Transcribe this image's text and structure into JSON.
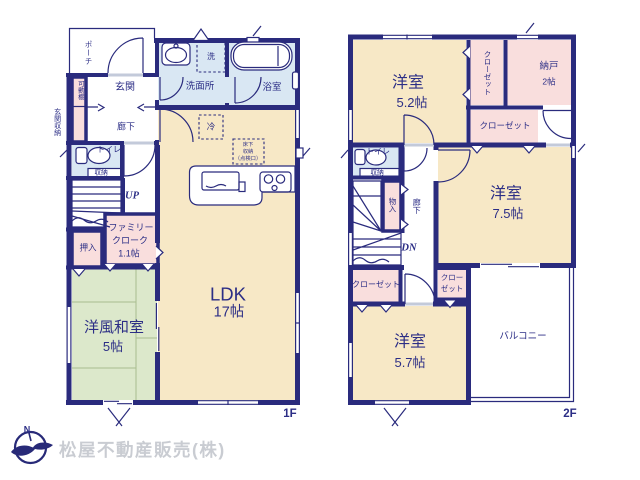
{
  "palette": {
    "wall": "#2a2b7d",
    "ink": "#2c2e86",
    "room": "#f7e8c6",
    "closet": "#f9dedd",
    "wet": "#d9e7f3",
    "tatami": "#dce8cb",
    "tatami_line": "#a9bd8f",
    "logo_text": "#c9ccd2",
    "logo_mark": "#282a78",
    "bg": "#ffffff"
  },
  "floor1": {
    "floor_label": "1F",
    "porch": "ポーチ",
    "movable_shelf": "可動棚",
    "entrance": "玄関",
    "entrance_storage": "玄関収納",
    "hallway": "廊下",
    "toilet": "トイレ",
    "toilet_storage": "収納",
    "stairs_up": "UP",
    "oshiire": "押入",
    "family_cloak_l1": "ファミリー",
    "family_cloak_l2": "クローク",
    "family_cloak_size": "1.1帖",
    "washroom": "洗面所",
    "washer": "洗",
    "bathroom": "浴室",
    "fridge": "冷",
    "underfloor_l1": "床下",
    "underfloor_l2": "収納",
    "underfloor_l3": "（点検口）",
    "ldk": "LDK",
    "ldk_size": "17帖",
    "tatami_room": "洋風和室",
    "tatami_room_size": "5帖"
  },
  "floor2": {
    "floor_label": "2F",
    "bedroom1": "洋室",
    "bedroom1_size": "5.2帖",
    "closet1": "クローゼット",
    "storeroom": "納戸",
    "storeroom_size": "2帖",
    "closet2": "クローゼット",
    "toilet": "トイレ",
    "toilet_storage": "収納",
    "monoire": "物入",
    "hallway": "廊下",
    "stairs_down": "DN",
    "bedroom2": "洋室",
    "bedroom2_size": "7.5帖",
    "closet3": "クローゼット",
    "closet4_l1": "クロー",
    "closet4_l2": "ゼット",
    "bedroom3": "洋室",
    "bedroom3_size": "5.7帖",
    "balcony": "バルコニー"
  },
  "footer": {
    "company": "松屋不動産販売(株)",
    "compass_north": "N"
  }
}
